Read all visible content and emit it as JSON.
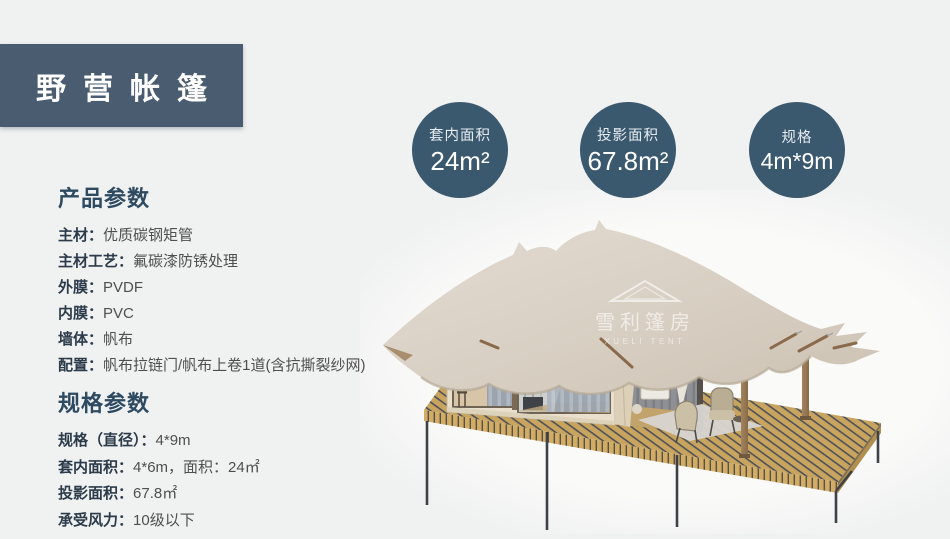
{
  "header": {
    "title": "野营帐篷"
  },
  "stats": [
    {
      "label": "套内面积",
      "value": "24m²"
    },
    {
      "label": "投影面积",
      "value": "67.8m²"
    },
    {
      "label": "规格",
      "value": "4m*9m"
    }
  ],
  "product_params": {
    "heading": "产品参数",
    "items": [
      {
        "label": "主材：",
        "value": "优质碳钢矩管"
      },
      {
        "label": "主材工艺：",
        "value": "氟碳漆防锈处理"
      },
      {
        "label": "外膜：",
        "value": "PVDF"
      },
      {
        "label": "内膜：",
        "value": "PVC"
      },
      {
        "label": "墙体：",
        "value": "帆布"
      },
      {
        "label": "配置：",
        "value": "帆布拉链门/帆布上卷1道(含抗撕裂纱网)"
      }
    ]
  },
  "spec_params": {
    "heading": "规格参数",
    "items": [
      {
        "label": "规格（直径）：",
        "value": "4*9m"
      },
      {
        "label": "套内面积：",
        "value": "4*6m，面积：24㎡"
      },
      {
        "label": "投影面积：",
        "value": "67.8㎡"
      },
      {
        "label": "承受风力：",
        "value": "10级以下"
      }
    ]
  },
  "watermark": {
    "cn": "雪利篷房",
    "en": "XUELI TENT"
  },
  "colors": {
    "page_bg": "#f0f1f1",
    "title_bg": "#4a5d70",
    "circle_bg": "#3a586e",
    "heading_text": "#2d4a60",
    "label_text": "#2b3b4a",
    "value_text": "#4f4f4f",
    "canopy": "#d8cfc3",
    "cabin_wall": "#e9dfcc",
    "deck_wood": "#c8a45e",
    "leg_metal": "#3d4247"
  }
}
